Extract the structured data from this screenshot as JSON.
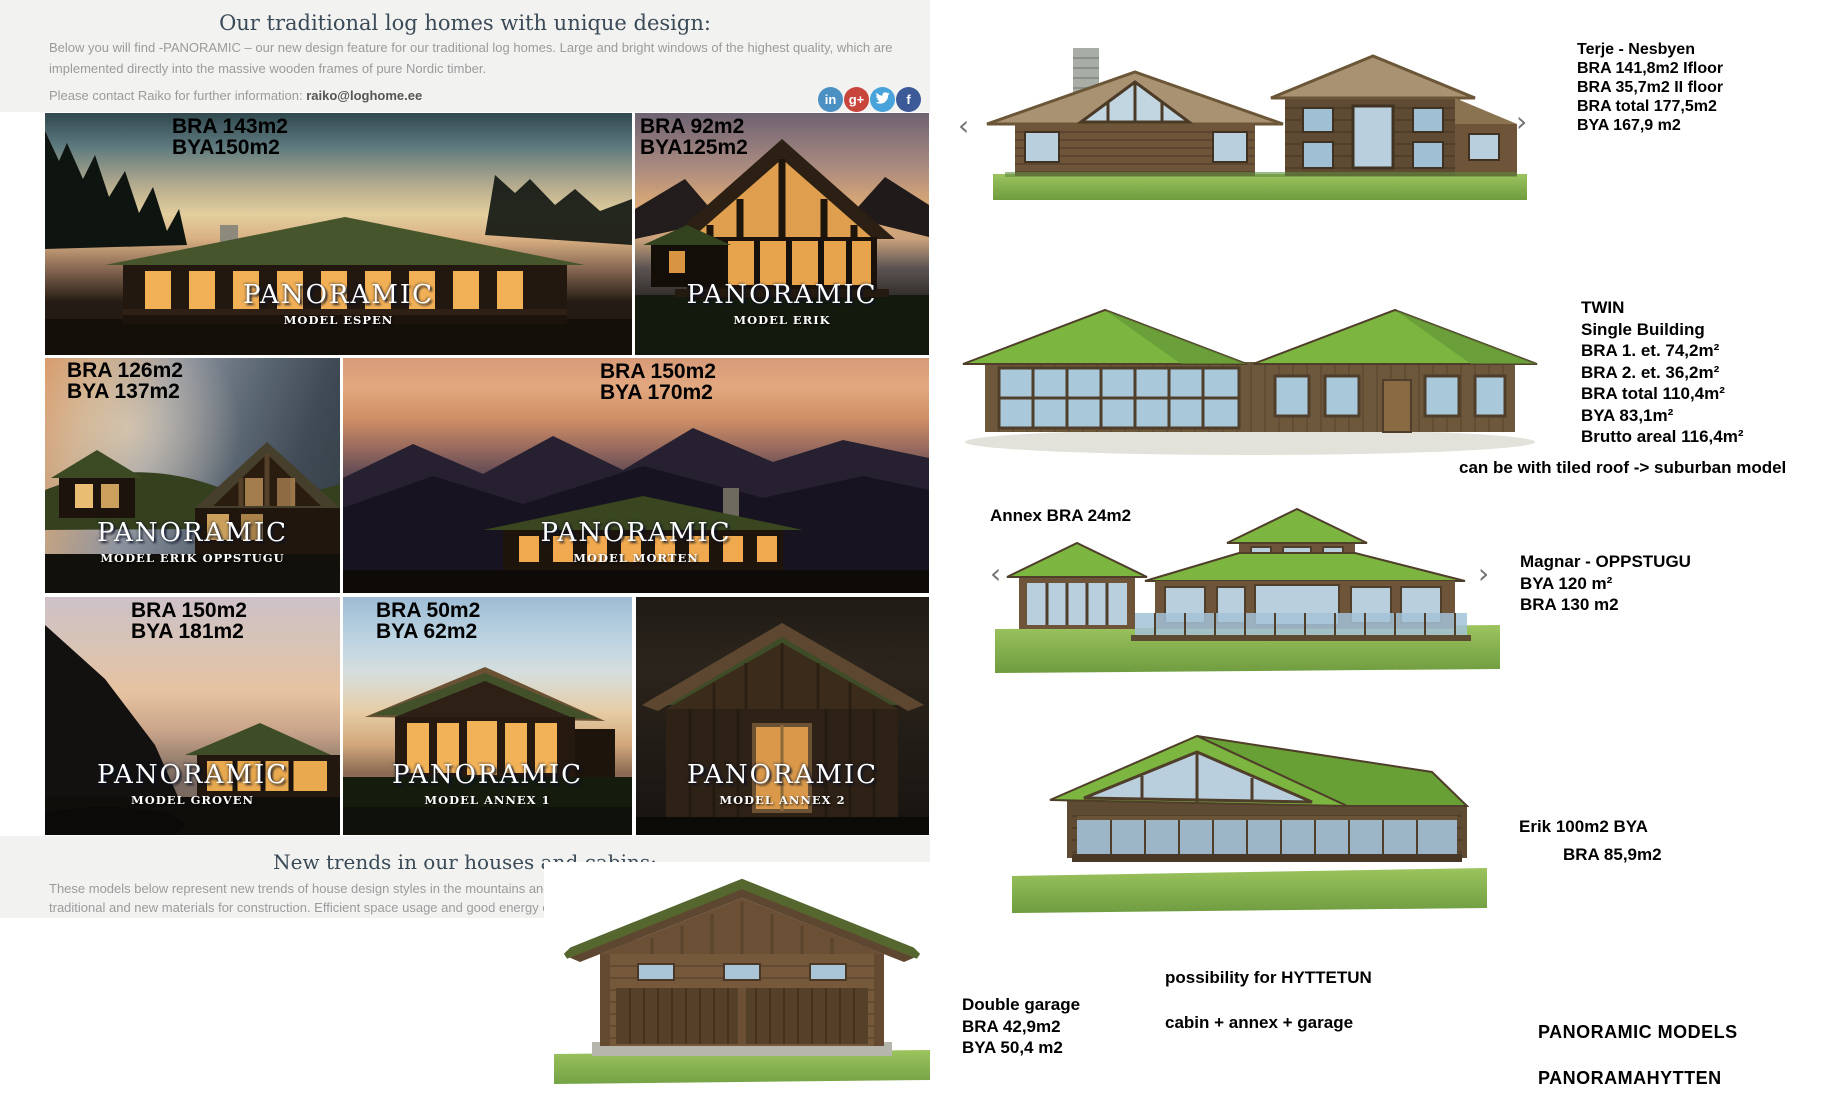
{
  "header": {
    "title": "Our traditional log homes with unique design:",
    "body_line1": "Below you will find -PANORAMIC – our new design feature for our traditional log homes. Large and bright windows of the highest quality, which are",
    "body_line2": "implemented directly into the massive wooden frames of pure Nordic timber.",
    "contact_prefix": "Please contact Raiko for further information: ",
    "contact_email": "raiko@loghome.ee",
    "social": [
      {
        "name": "linkedin",
        "glyph": "in",
        "color": "#4a90c2"
      },
      {
        "name": "google-plus",
        "glyph": "g+",
        "color": "#c8453c"
      },
      {
        "name": "twitter",
        "glyph": "bird",
        "color": "#47a3d9"
      },
      {
        "name": "facebook",
        "glyph": "f",
        "color": "#3b5a97"
      }
    ]
  },
  "gallery": [
    {
      "bra": "BRA 143m2",
      "bya": "BYA150m2",
      "brand": "PANORAMIC",
      "model": "MODEL ESPEN"
    },
    {
      "bra": "BRA 92m2",
      "bya": "BYA125m2",
      "brand": "PANORAMIC",
      "model": "MODEL ERIK"
    },
    {
      "bra": "BRA 126m2",
      "bya": "BYA 137m2",
      "brand": "PANORAMIC",
      "model": "MODEL ERIK OPPSTUGU"
    },
    {
      "bra": "BRA 150m2",
      "bya": "BYA 170m2",
      "brand": "PANORAMIC",
      "model": "MODEL MORTEN"
    },
    {
      "bra": "BRA 150m2",
      "bya": "BYA 181m2",
      "brand": "PANORAMIC",
      "model": "MODEL GROVEN"
    },
    {
      "bra": "BRA 50m2",
      "bya": "BYA 62m2",
      "brand": "PANORAMIC",
      "model": "MODEL ANNEX 1"
    },
    {
      "brand": "PANORAMIC",
      "model": "MODEL ANNEX 2"
    }
  ],
  "trends": {
    "title": "New trends in our houses and cabins:",
    "body_line1": "These models below represent new trends of house design styles in the mountains and",
    "body_line2": "traditional and new materials for construction. Efficient space usage and good energy ef"
  },
  "right_panel": {
    "carousel_prev": "‹",
    "carousel_next": "›",
    "terje": {
      "lines": [
        "Terje - Nesbyen",
        "BRA 141,8m2 Ifloor",
        "BRA 35,7m2 II floor",
        "BRA total 177,5m2",
        "BYA 167,9 m2"
      ]
    },
    "twin": {
      "lines": [
        "TWIN",
        "Single Building",
        "BRA 1. et. 74,2m²",
        "BRA 2. et. 36,2m²",
        "BRA total 110,4m²",
        "BYA 83,1m²",
        "Brutto areal 116,4m²"
      ],
      "note": "can be with tiled roof -> suburban model"
    },
    "magnar": {
      "annex_label": "Annex BRA 24m2",
      "lines": [
        "Magnar - OPPSTUGU",
        "BYA 120 m²",
        "BRA 130 m2"
      ]
    },
    "erik": {
      "line1": "Erik 100m2 BYA",
      "line2": "BRA 85,9m2"
    },
    "garage": {
      "lines": [
        "Double garage",
        "BRA 42,9m2",
        "BYA 50,4 m2"
      ]
    },
    "hyttetun": {
      "line1": "possibility for HYTTETUN",
      "line2": "cabin + annex + garage"
    },
    "footer": {
      "line1": "PANORAMIC MODELS",
      "line2": "PANORAMAHYTTEN"
    }
  },
  "colors": {
    "header_bg": "#f2f2f1",
    "title_text": "#3a4a57",
    "body_text": "#9b9b9b",
    "grass_roof_green": "#7cb53f",
    "wood_brown": "#6e5438",
    "glass_blue": "#b9cfdd",
    "social_linkedin": "#4a90c2",
    "social_google_plus": "#c8453c",
    "social_twitter": "#47a3d9",
    "social_facebook": "#3b5a97"
  }
}
